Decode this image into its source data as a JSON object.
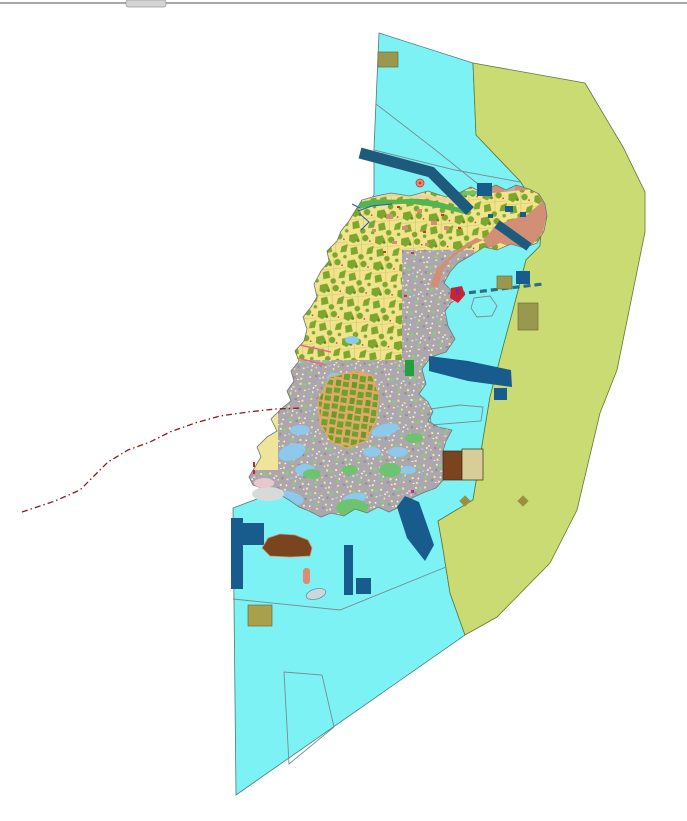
{
  "chrome": {
    "top_rule_color": "#a8a8a8",
    "scroll_tab_color": "#d4d4d4"
  },
  "map": {
    "semantic_name": "island-land-use-planning-map",
    "colors": {
      "background": "#ffffff",
      "water": "#7df2f4",
      "water_outline": "#4a7a84",
      "coastal_zone": "#cbdb74",
      "coastal_zone_outline": "#5f7a33",
      "island_base": "#efe49c",
      "island_outline": "#6b7a70",
      "parcel_yellow": "#f1e48d",
      "vegetation_olive": "#7ca72e",
      "vegetation_dark": "#5f8e1f",
      "urban_gray": "#aca6ae",
      "orchard_tan": "#dfa968",
      "orchard_cell": "#6fa02c",
      "salmon": "#d28f76",
      "harbor_navy": "#175c8c",
      "band_navy": "#1e5a7c",
      "causeway_teal": "#2e6e80",
      "khaki": "#9a974e",
      "khaki_light": "#a8a04a",
      "brown": "#7a441e",
      "pale_khaki_panel": "#d6ce96",
      "shore_green": "#52b552",
      "sand_tan": "#e9d3a3",
      "green_patch": "#6ec46e",
      "bright_green": "#22a040",
      "light_blue_flat": "#8cc9ea",
      "boundary_dash_red": "#8e1a1a",
      "thin_line_gray": "#7a8a92",
      "stream_blue": "#2255cc",
      "pink_line": "#e06c8c",
      "red_speck": "#cc3333",
      "magenta_speck": "#c428a8",
      "purple_speck": "#8e2d9e",
      "gray_notch": "#b0afb8",
      "pebble_gray": "#c9d9e2",
      "light_gray_blob": "#d9d9d9",
      "pink_patch": "#e8c8d0",
      "salmon_pill": "#d98d72",
      "marker_ring": "#e09070"
    }
  }
}
